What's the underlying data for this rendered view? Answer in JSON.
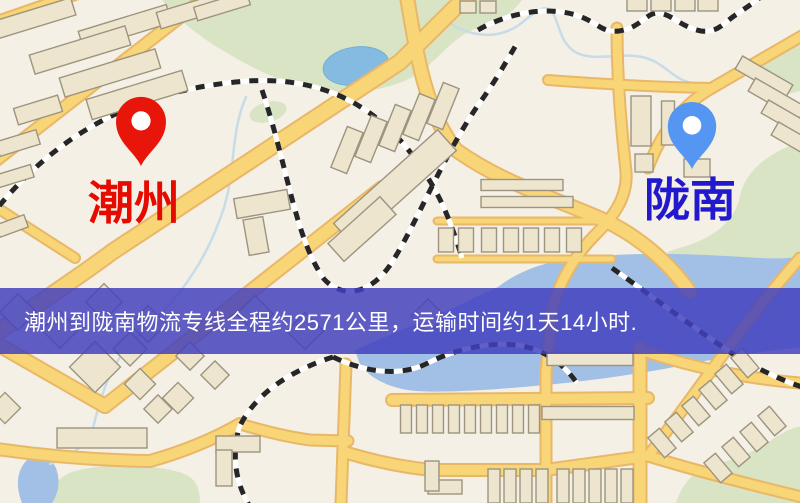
{
  "banner": {
    "text": "潮州到陇南物流专线全程约2571公里，运输时间约1天14小时."
  },
  "origin": {
    "city": "潮州",
    "pin_icon": "map-pin"
  },
  "destination": {
    "city": "陇南",
    "pin_icon": "map-pin"
  },
  "route": {
    "distance_text": "约2571公里",
    "duration_text": "约1天14小时"
  },
  "colors": {
    "map_background": "#f4f0e6",
    "road_fill": "#f8d576",
    "road_casing": "#e9b768",
    "building_fill": "#ede5cd",
    "building_stroke": "#9d9480",
    "green_area": "#d9e4c5",
    "water_main": "#a2c0e6",
    "water_pond": "#86bbe1",
    "railway_tie": "#262626",
    "railway_base": "#ffffff",
    "stream": "#c7dce8",
    "banner_background": "#423fbe",
    "banner_text_color": "#ffffff",
    "origin_pin": "#e8150a",
    "origin_label": "#e60b00",
    "destination_pin": "#5596f2",
    "destination_label": "#2219cf",
    "pin_hole": "#ffffff"
  }
}
